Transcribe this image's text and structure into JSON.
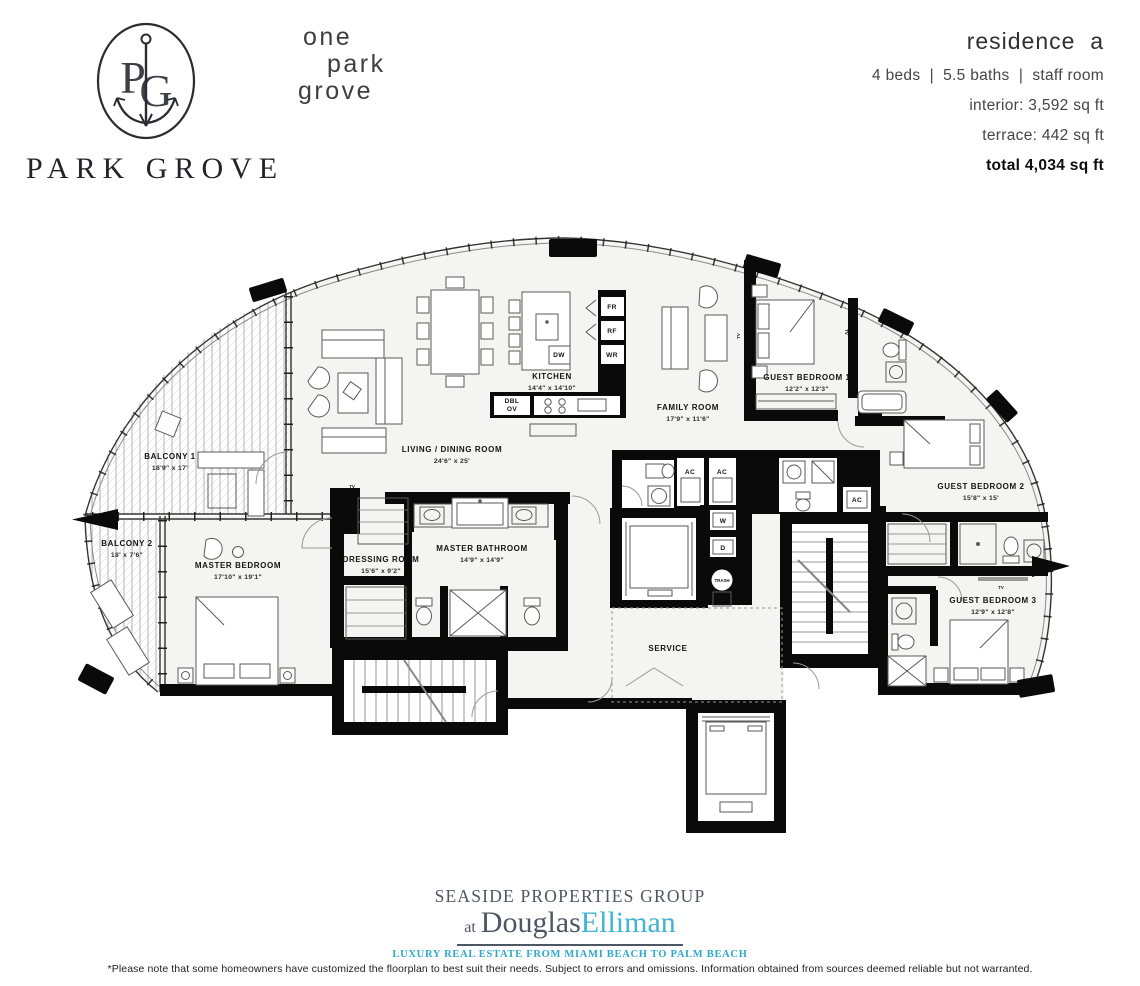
{
  "brand": {
    "monogram": "PG",
    "name": "PARK GROVE",
    "building_lines": [
      "one",
      "park",
      "grove"
    ]
  },
  "residence": {
    "title": "residence  a",
    "specs": "4 beds  |  5.5 baths  |  staff room",
    "interior": "interior: 3,592 sq ft",
    "terrace": "terrace: 442 sq ft",
    "total": "total 4,034 sq ft"
  },
  "floorplan": {
    "rooms": [
      {
        "name": "BALCONY 1",
        "dims": "18'9\" x 17'"
      },
      {
        "name": "BALCONY 2",
        "dims": "18' x 7'6\""
      },
      {
        "name": "MASTER BEDROOM",
        "dims": "17'10\" x 19'1\""
      },
      {
        "name": "DRESSING ROOM",
        "dims": "15'6\" x 9'2\""
      },
      {
        "name": "MASTER BATHROOM",
        "dims": "14'9\" x 14'9\""
      },
      {
        "name": "LIVING / DINING ROOM",
        "dims": "24'6\" x 25'"
      },
      {
        "name": "KITCHEN",
        "dims": "14'4\" x 14'10\""
      },
      {
        "name": "FAMILY ROOM",
        "dims": "17'9\" x 11'6\""
      },
      {
        "name": "GUEST BEDROOM 1",
        "dims": "12'2\" x 12'3\""
      },
      {
        "name": "GUEST BEDROOM 2",
        "dims": "15'8\" x 15'"
      },
      {
        "name": "GUEST BEDROOM 3",
        "dims": "12'9\" x 12'8\""
      },
      {
        "name": "SERVICE",
        "dims": ""
      }
    ],
    "appliances": {
      "fr": "FR",
      "rf": "RF",
      "wr": "WR",
      "dw": "DW",
      "dbl": "DBL",
      "ov": "OV"
    },
    "utilities": {
      "ac": "AC",
      "w": "W",
      "d": "D",
      "trash": "TRASH",
      "tv": "TV"
    }
  },
  "footer": {
    "group_name": "SEASIDE PROPERTIES GROUP",
    "at": "at",
    "brand_part1": "Douglas",
    "brand_part2": "Elliman",
    "tagline": "LUXURY REAL ESTATE FROM MIAMI BEACH TO PALM BEACH",
    "colors": {
      "slate": "#4d5663",
      "cyan": "#41b3d3"
    }
  },
  "disclaimer": "*Please note that some homeowners have customized the floorplan to best suit their needs. Subject to errors and omissions. Information obtained from sources deemed reliable but not warranted."
}
